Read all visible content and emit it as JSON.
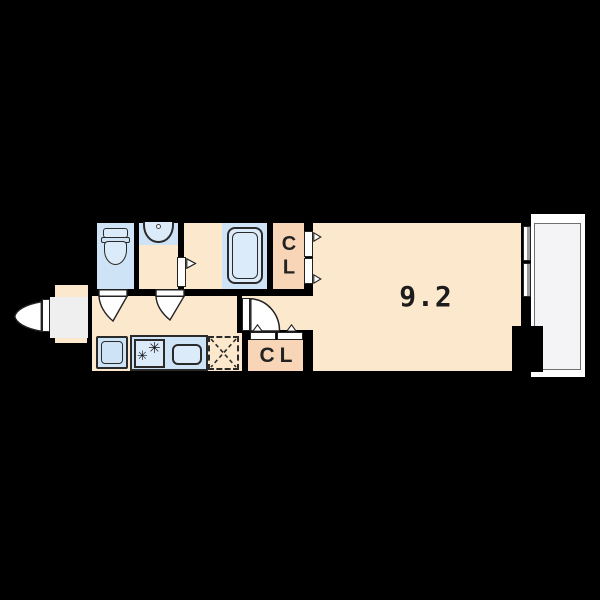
{
  "palette": {
    "bg": "#000000",
    "wall": "#000000",
    "floor_cream": "#fce8cd",
    "fixture_blue": "#cfe3f6",
    "fixture_blue_light": "#dcebfa",
    "closet_salmon": "#f8d5b7",
    "entry_gray": "#efeff0",
    "balcony_floor": "#f4f4f6",
    "balcony_wall": "#ffffff",
    "outline_dark": "#2a2a2a",
    "text_dark": "#1c1c1c"
  },
  "labels": {
    "main_room_size": "9.2",
    "closet_top": "CL",
    "closet_bottom": "CL"
  },
  "icons": {
    "stove_burner": "✳"
  }
}
